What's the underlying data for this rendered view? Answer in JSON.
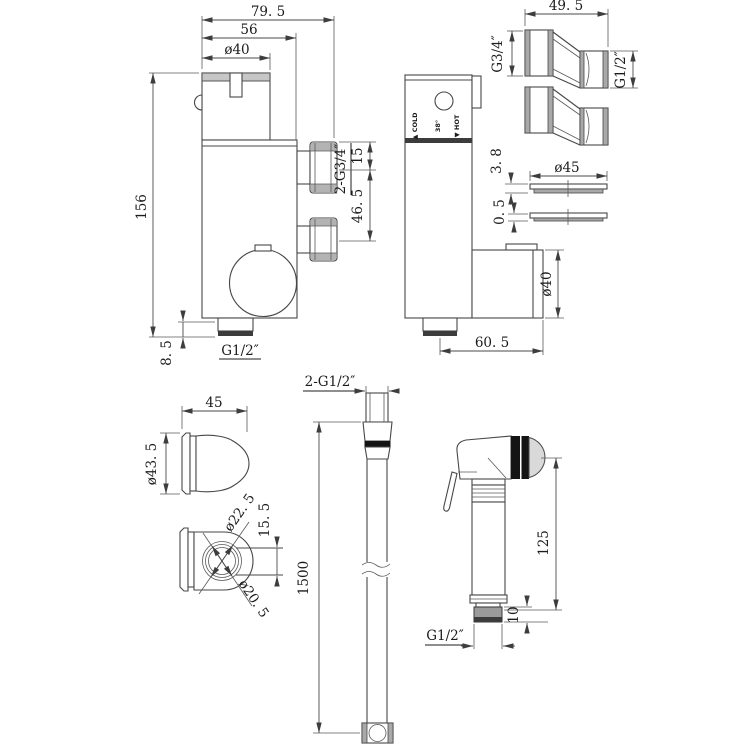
{
  "drawing": {
    "kind": "technical-dimension-drawing",
    "views": {
      "valve_front": {
        "dims": {
          "width_total": "79. 5",
          "width_body": "56",
          "knob_dia": "ø40",
          "height": "156",
          "outlet_length": "8. 5",
          "outlet_thread": "G1/2″",
          "inlet_thread": "2-G3/4″",
          "inlet_top": "15",
          "inlet_spacing": "46. 5"
        }
      },
      "valve_side": {
        "panel": {
          "cold": "▲ COLD",
          "temp": "38°",
          "hot": "▼ HOT"
        },
        "dims": {
          "knob_dia": "ø40",
          "depth": "60. 5"
        }
      },
      "adapters": {
        "dims": {
          "length": "49. 5",
          "thread_large": "G3/4″",
          "thread_small": "G1/2″"
        }
      },
      "discs": {
        "dims": {
          "diameter": "ø45",
          "thickness_top": "3. 8",
          "thickness_bottom": "0. 5"
        }
      },
      "bracket_side": {
        "dims": {
          "depth": "45",
          "diameter": "ø43. 5"
        }
      },
      "bracket_bottom": {
        "dims": {
          "bore_outer": "ø22. 5",
          "bore_inner": "ø20. 5",
          "slot_width": "15. 5"
        }
      },
      "hose": {
        "dims": {
          "end_threads": "2-G1/2″",
          "length": "1500"
        }
      },
      "sprayer": {
        "dims": {
          "height": "125",
          "thread_length": "10",
          "thread": "G1/2″"
        }
      }
    }
  }
}
